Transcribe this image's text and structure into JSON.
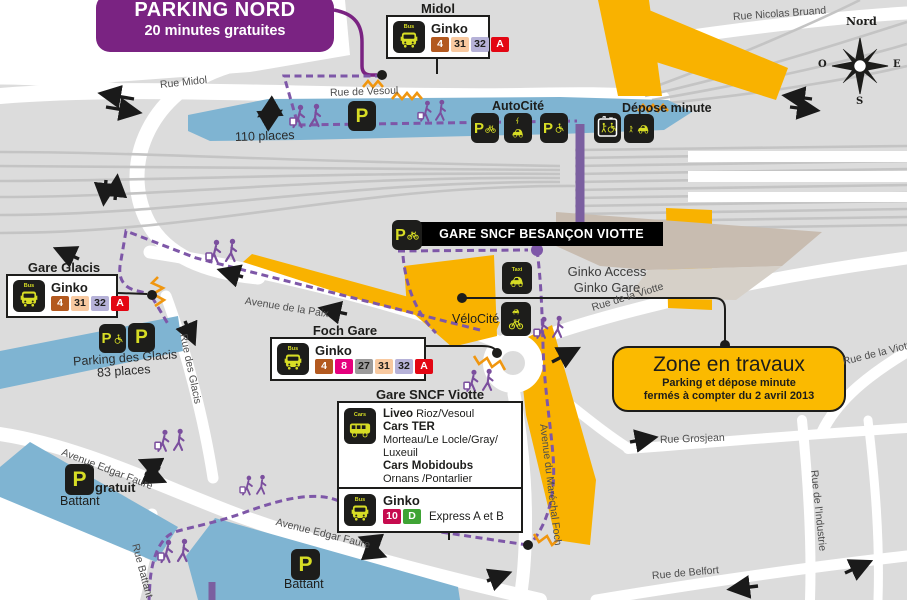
{
  "banner": {
    "title": "PARKING NORD",
    "subtitle": "20 minutes gratuites"
  },
  "station": {
    "banner": "GARE SNCF BESANÇON VIOTTE",
    "ginko_access": "Ginko Access",
    "ginko_gare": "Ginko Gare",
    "velocite": "VéloCité"
  },
  "glyphs": {
    "p": "P",
    "bus_mini": "Bus",
    "taxi_mini": "Taxi",
    "cars_mini": "Cars"
  },
  "parkings": {
    "nord_places": "110 places",
    "autocite": "AutoCité",
    "depose_minute": "Dépose minute",
    "glacis_name": "Parking des Glacis",
    "glacis_places": "83 places",
    "battant_gratuit": "gratuit",
    "battant_1": "Battant",
    "battant_2": "Battant"
  },
  "travaux": {
    "title": "Zone en travaux",
    "line1": "Parking et dépose minute",
    "line2": "fermés à compter du 2 avril 2013"
  },
  "stops": {
    "midol": {
      "name": "Midol",
      "operator": "Ginko",
      "lines": [
        {
          "label": "4",
          "bg": "#b3591f",
          "fg": "#ffffff"
        },
        {
          "label": "31",
          "bg": "#f8c9a0",
          "fg": "#1d1d1b"
        },
        {
          "label": "32",
          "bg": "#b6b2d8",
          "fg": "#1d1d1b"
        },
        {
          "label": "A",
          "bg": "#e30613",
          "fg": "#ffffff"
        }
      ]
    },
    "gare_glacis": {
      "name": "Gare Glacis",
      "operator": "Ginko",
      "lines": [
        {
          "label": "4",
          "bg": "#b3591f",
          "fg": "#ffffff"
        },
        {
          "label": "31",
          "bg": "#f8c9a0",
          "fg": "#1d1d1b"
        },
        {
          "label": "32",
          "bg": "#b6b2d8",
          "fg": "#1d1d1b"
        },
        {
          "label": "A",
          "bg": "#e30613",
          "fg": "#ffffff"
        }
      ]
    },
    "foch_gare": {
      "name": "Foch Gare",
      "operator": "Ginko",
      "lines": [
        {
          "label": "4",
          "bg": "#b3591f",
          "fg": "#ffffff"
        },
        {
          "label": "8",
          "bg": "#e5007d",
          "fg": "#ffffff"
        },
        {
          "label": "27",
          "bg": "#9c9b9b",
          "fg": "#1d1d1b"
        },
        {
          "label": "31",
          "bg": "#f8c9a0",
          "fg": "#1d1d1b"
        },
        {
          "label": "32",
          "bg": "#b6b2d8",
          "fg": "#1d1d1b"
        },
        {
          "label": "A",
          "bg": "#e30613",
          "fg": "#ffffff"
        }
      ]
    },
    "viotte": {
      "name": "Gare SNCF Viotte",
      "coaches": {
        "liveo": "Liveo",
        "liveo_dest": "Rioz/Vesoul",
        "ter": "Cars TER",
        "ter_dest": "Morteau/Le Locle/Gray/ Luxeuil",
        "mobidoubs": "Cars Mobidoubs",
        "mobidoubs_dest1": "Ornans /Pontarlier",
        "mobidoubs_dest2": "Nods/Pontarlier"
      },
      "bus": {
        "operator": "Ginko",
        "note": "Express A et B",
        "lines": [
          {
            "label": "10",
            "bg": "#c60b4e",
            "fg": "#ffffff"
          },
          {
            "label": "D",
            "bg": "#3fa435",
            "fg": "#ffffff"
          }
        ]
      }
    }
  },
  "streets": {
    "rue_midol": "Rue Midol",
    "rue_de_vesoul": "Rue de Vesoul",
    "rue_nicolas_bruand": "Rue Nicolas Bruand",
    "avenue_de_la_paix": "Avenue de la Paix",
    "rue_des_glacis": "Rue des Glacis",
    "rue_de_la_viotte_1": "Rue de la Viotte",
    "rue_de_la_viotte_2": "Rue de la Viotte",
    "avenue_du_marechal_foch": "Avenue du Maréchal Foch",
    "rue_grosjean": "Rue Grosjean",
    "rue_de_l_industrie": "Rue de l'Industrie",
    "avenue_edgar_faure_1": "Avenue Edgar Faure",
    "avenue_edgar_faure_2": "Avenue Edgar Faure",
    "rue_battant": "Rue Battant",
    "rue_de_belfort": "Rue de Belfort"
  },
  "compass": {
    "north": "Nord",
    "east": "E",
    "south": "S",
    "west": "O"
  },
  "colors": {
    "background": "#dcdcdc",
    "road": "#ffffff",
    "track": "#c4c4c4",
    "parking_blue": "#7fb4d2",
    "works_yellow": "#f9b200",
    "travaux_box": "#fbba00",
    "building_beige": "#c8bcb0",
    "building_light": "#d6d0c8",
    "purple_banner": "#7a2382",
    "path_purple": "#7e57a8",
    "badge_black": "#1d1d1b",
    "glyph_yellow": "#d7dd25",
    "stair_orange": "#f0960f"
  }
}
